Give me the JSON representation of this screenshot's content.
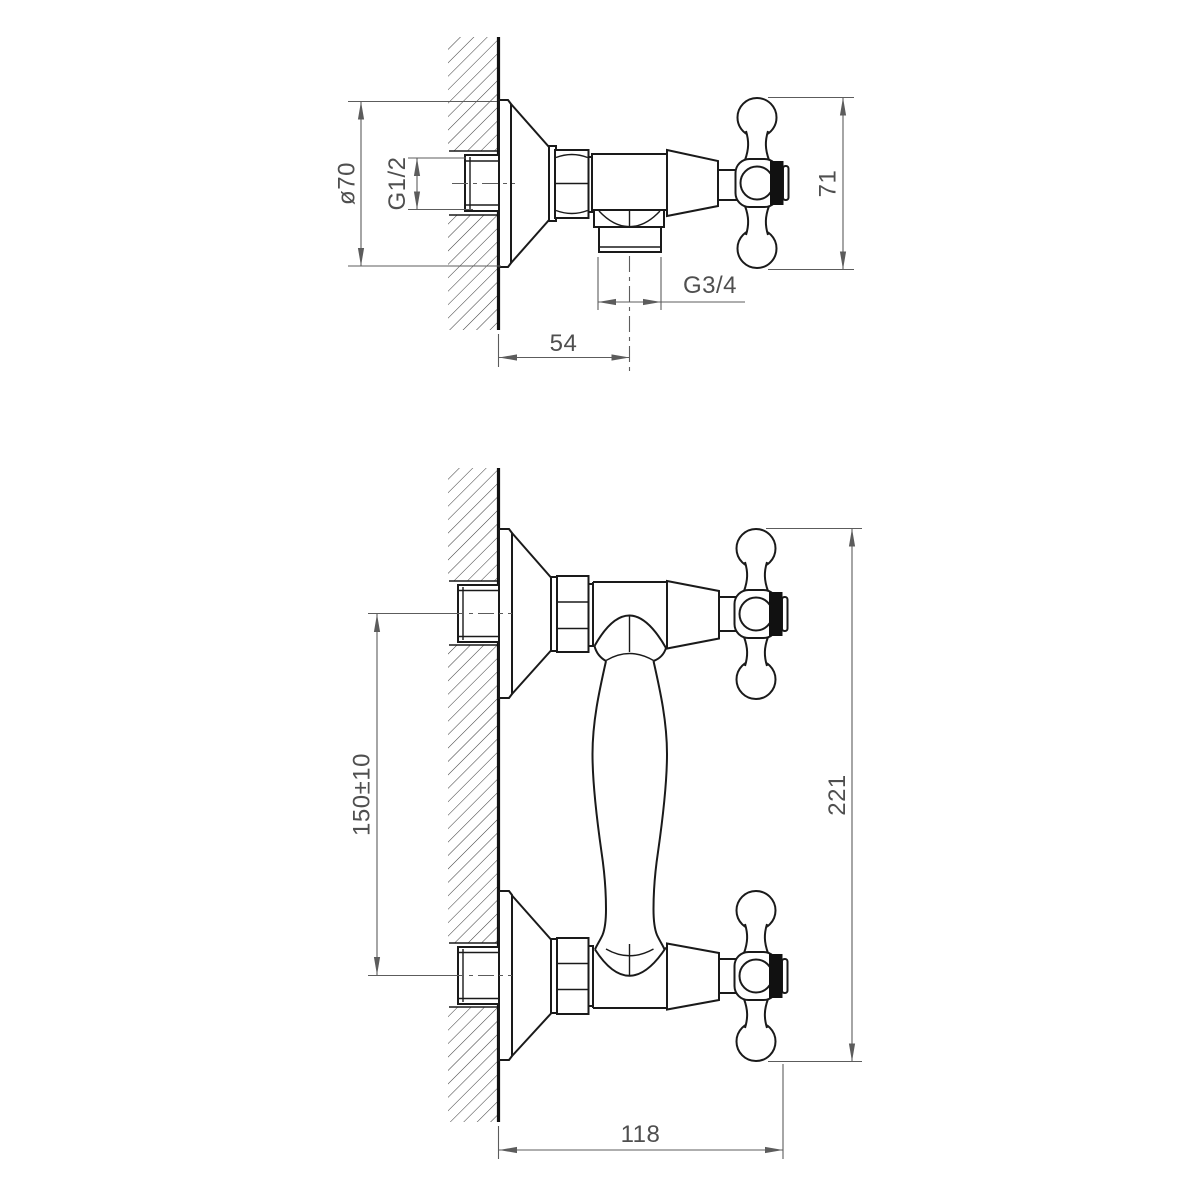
{
  "colors": {
    "background": "#ffffff",
    "object_line": "#1a1a1a",
    "dimension_line": "#5c5c5c",
    "hatch_line": "#3e3e3e",
    "handle_cap": "#111111",
    "text": "#4f4f4f"
  },
  "side_view": {
    "dim_escutcheon_diameter": "ø70",
    "dim_inlet_thread": "G1/2",
    "dim_handle_height": "71",
    "dim_outlet_thread": "G3/4",
    "dim_wall_to_outlet": "54"
  },
  "front_view": {
    "dim_inlet_spacing": "150±10",
    "dim_overall_height": "221",
    "dim_wall_to_handle": "118"
  }
}
